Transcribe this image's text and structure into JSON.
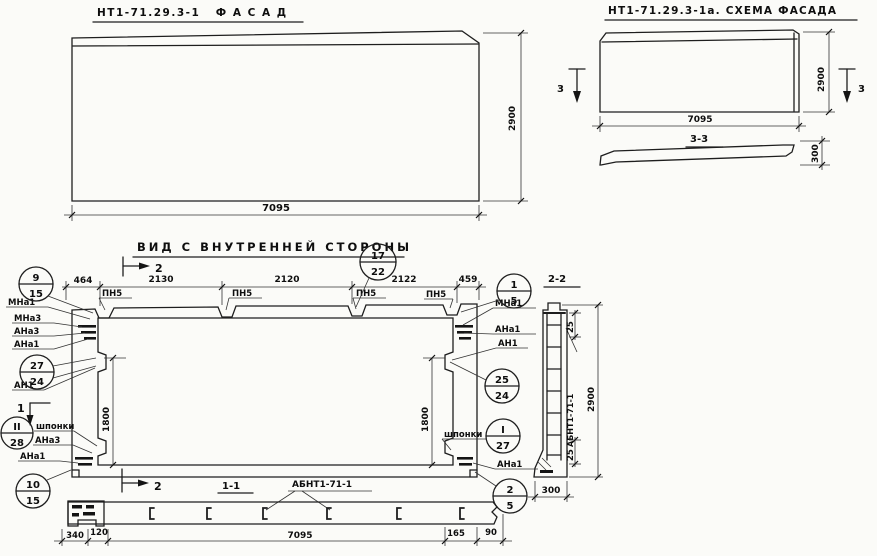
{
  "facade": {
    "title": "НТ1-71.29.3-1   Ф А С А Д",
    "width": "7095",
    "height": "2900"
  },
  "schema": {
    "title": "НТ1-71.29.3-1а. СХЕМА ФАСАДА",
    "cut_left": "3",
    "cut_right": "3",
    "width": "7095",
    "height": "2900",
    "section_title": "3-3",
    "thickness": "300"
  },
  "view": {
    "title": "ВИД С ВНУТРЕННЕЙ СТОРОНЫ",
    "cut2": "2",
    "cut1": "1",
    "dims": {
      "d464": "464",
      "d2130": "2130",
      "d2120": "2120",
      "d2122": "2122",
      "d459": "459",
      "left1800": "1800",
      "right1800": "1800"
    },
    "pn5": [
      "ПН5",
      "ПН5",
      "ПН5",
      "ПН5"
    ],
    "left": {
      "mna1": "МНа1",
      "mna3": "МНа3",
      "ana3": "АНа3",
      "ana1": "АНа1",
      "an1": "АН1",
      "shponki": "шпонки",
      "ana3b": "АНа3",
      "ana1b": "АНа1"
    },
    "right": {
      "mna1": "МНа1",
      "ana1": "АНа1",
      "an1": "АН1",
      "shponki": "шпонки",
      "ana1b": "АНа1"
    },
    "callouts": {
      "c9_15": {
        "top": "9",
        "bot": "15"
      },
      "c17_22": {
        "top": "17",
        "bot": "22"
      },
      "c1_5": {
        "top": "1",
        "bot": "5"
      },
      "c27_24": {
        "top": "27",
        "bot": "24"
      },
      "c25_24": {
        "top": "25",
        "bot": "24"
      },
      "c2_28": {
        "top": "II",
        "bot": "28"
      },
      "c1_27": {
        "top": "I",
        "bot": "27"
      },
      "c10_15": {
        "top": "10",
        "bot": "15"
      },
      "c2_5": {
        "top": "2",
        "bot": "5"
      }
    }
  },
  "section22": {
    "title": "2-2",
    "d25top": "25",
    "d25bot": "25",
    "bar": "АБНТ1-71-1",
    "height": "2900",
    "width": "300"
  },
  "section11": {
    "title": "1-1",
    "cut2": "2",
    "bar": "АБНТ1-71-1",
    "d340": "340",
    "d120": "120",
    "d165": "165",
    "d90": "90",
    "total": "7095"
  }
}
